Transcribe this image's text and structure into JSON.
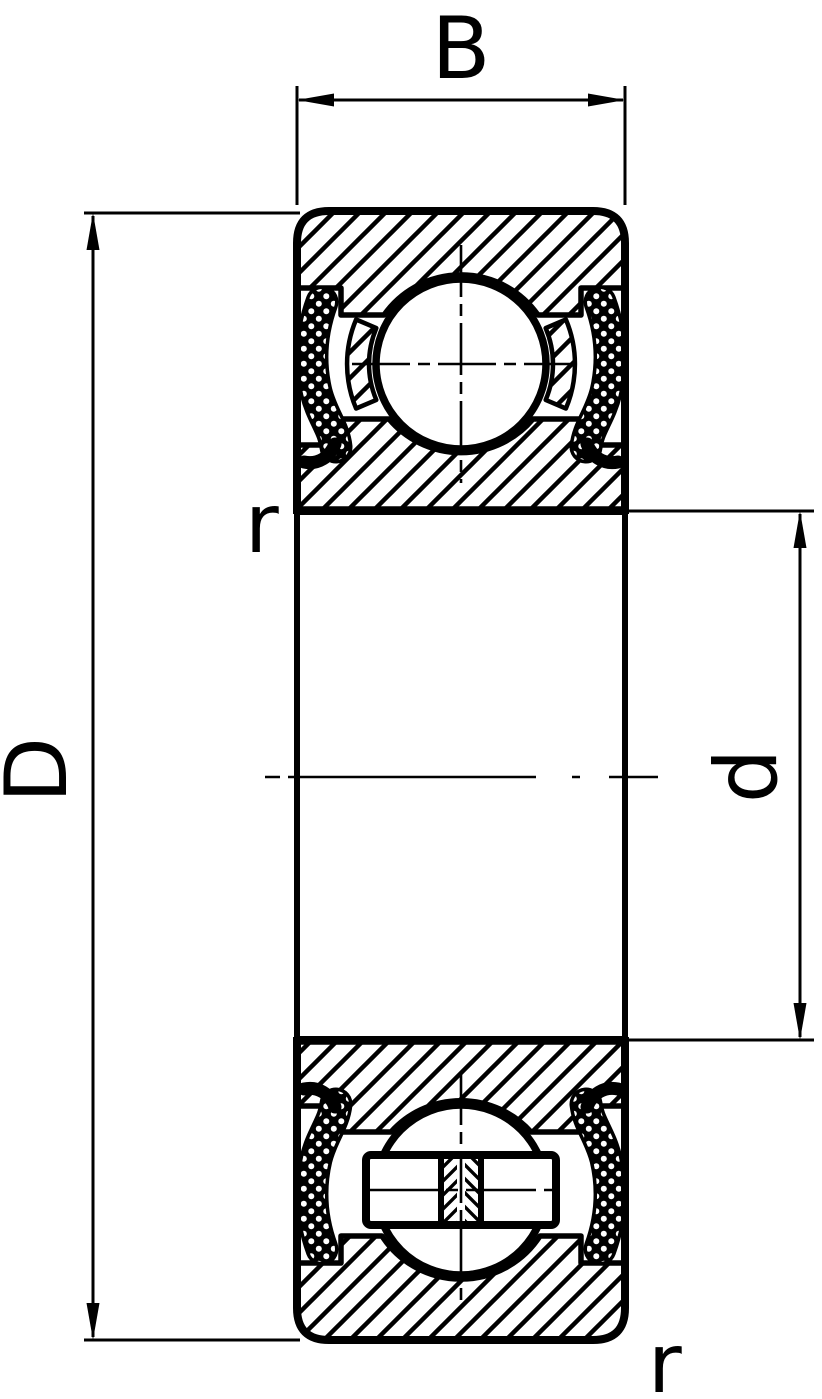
{
  "figure": {
    "kind": "engineering cross-section drawing",
    "subject": "sealed deep groove ball bearing",
    "ink_color": "#000000",
    "paper_color": "#ffffff"
  },
  "labels": {
    "width": "B",
    "outer_diameter": "D",
    "bore_diameter": "d",
    "radius_upper": "r",
    "radius_lower": "r"
  }
}
